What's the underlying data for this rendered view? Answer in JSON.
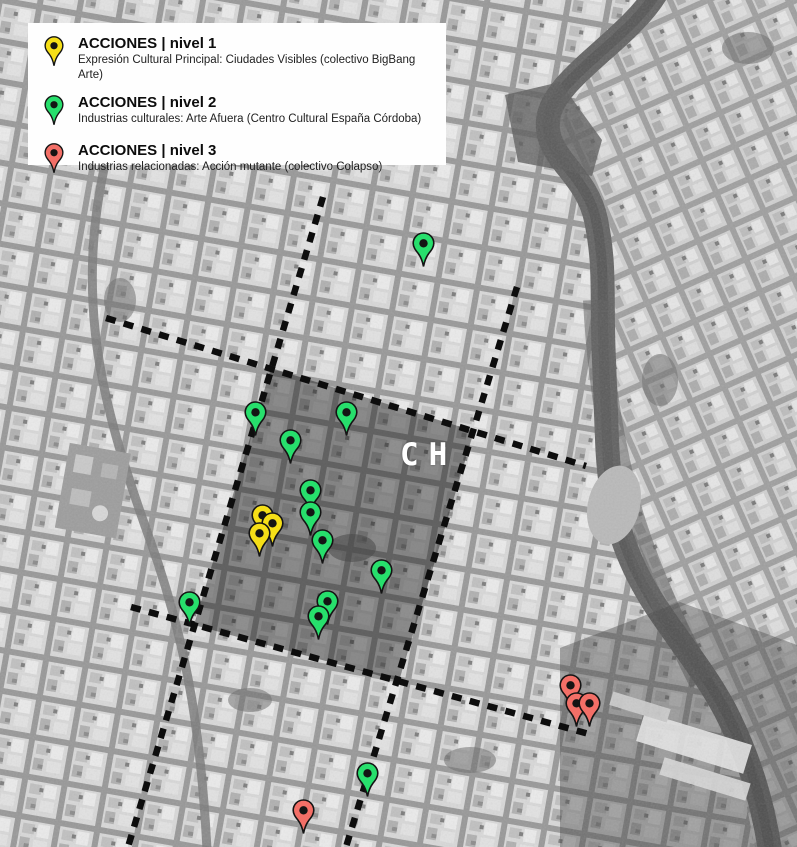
{
  "legend": {
    "items": [
      {
        "level": 1,
        "title": "ACCIONES | nivel 1",
        "description": "Expresión Cultural Principal: Ciudades Visibles (colectivo BigBang Arte)"
      },
      {
        "level": 2,
        "title": "ACCIONES | nivel 2",
        "description": "Industrias culturales: Arte Afuera (Centro Cultural España Córdoba)"
      },
      {
        "level": 3,
        "title": "ACCIONES | nivel 3",
        "description": "Industrias relacionadas: Acción mutante (colectivo Colapso)"
      }
    ]
  },
  "map": {
    "zone_label": "CH",
    "pin_colors": {
      "level1": "#f6df17",
      "level2": "#27df6c",
      "level3": "#f36f67"
    },
    "pin_outline": "#141414",
    "markers": [
      {
        "level": 2,
        "x": 423,
        "y": 243
      },
      {
        "level": 2,
        "x": 255,
        "y": 412
      },
      {
        "level": 2,
        "x": 346,
        "y": 412
      },
      {
        "level": 2,
        "x": 290,
        "y": 440
      },
      {
        "level": 2,
        "x": 310,
        "y": 490
      },
      {
        "level": 2,
        "x": 310,
        "y": 512
      },
      {
        "level": 1,
        "x": 262,
        "y": 515
      },
      {
        "level": 1,
        "x": 272,
        "y": 523
      },
      {
        "level": 1,
        "x": 259,
        "y": 533
      },
      {
        "level": 2,
        "x": 322,
        "y": 540
      },
      {
        "level": 2,
        "x": 381,
        "y": 570
      },
      {
        "level": 2,
        "x": 327,
        "y": 601
      },
      {
        "level": 2,
        "x": 189,
        "y": 602
      },
      {
        "level": 2,
        "x": 318,
        "y": 616
      },
      {
        "level": 3,
        "x": 570,
        "y": 685
      },
      {
        "level": 3,
        "x": 576,
        "y": 703
      },
      {
        "level": 3,
        "x": 589,
        "y": 703
      },
      {
        "level": 2,
        "x": 367,
        "y": 773
      },
      {
        "level": 3,
        "x": 303,
        "y": 810
      }
    ]
  }
}
